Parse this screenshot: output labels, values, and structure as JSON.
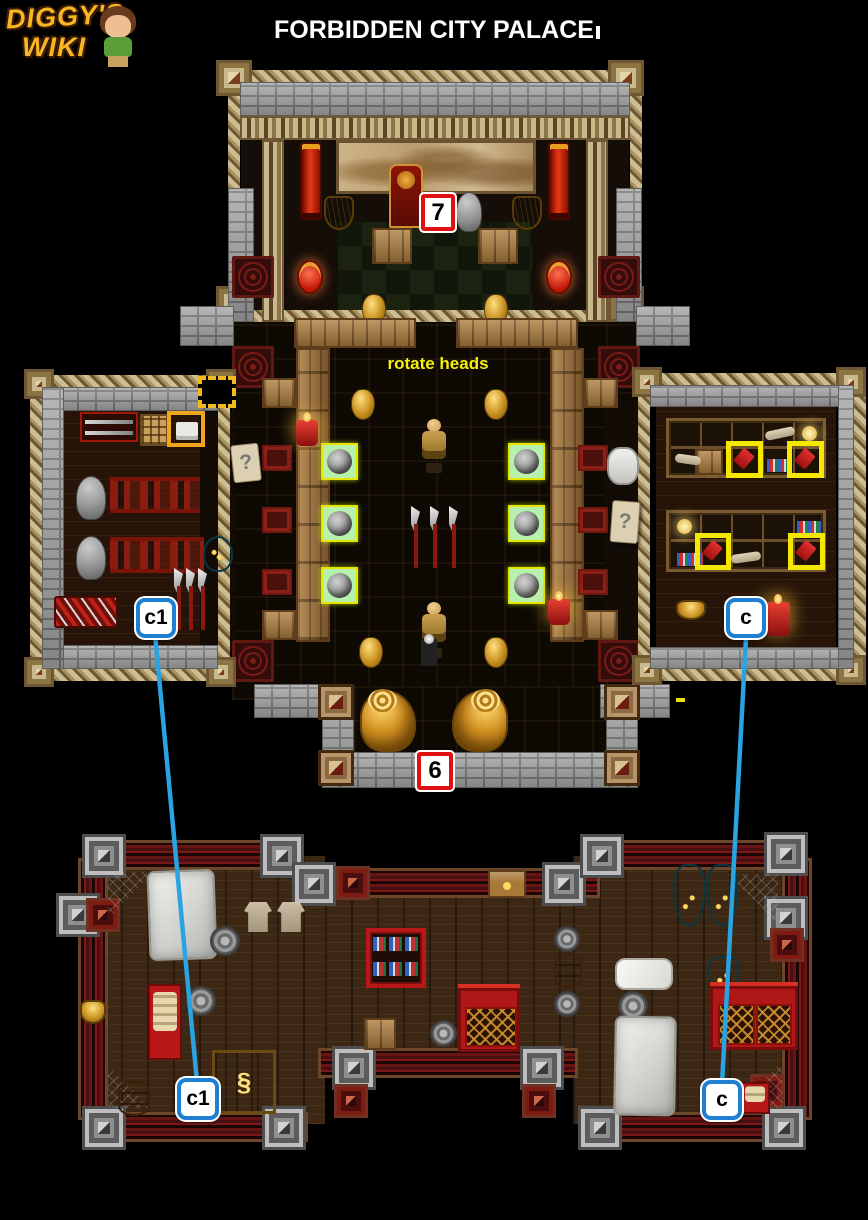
{
  "header": {
    "logo_line1": "DIGGY'S",
    "logo_line2": "WIKI",
    "title": "FORBIDDEN CITY PALACE"
  },
  "annotations": {
    "rotate_heads": "rotate heads",
    "question_left": "?",
    "question_right": "?"
  },
  "markers": {
    "m7": {
      "label": "7",
      "style": "red-square"
    },
    "m6": {
      "label": "6",
      "style": "red-square"
    },
    "c1_upper": {
      "label": "c1",
      "style": "blue-rounded"
    },
    "c_upper": {
      "label": "c",
      "style": "blue-rounded"
    },
    "c1_lower": {
      "label": "c1",
      "style": "blue-rounded"
    },
    "c_lower": {
      "label": "c",
      "style": "blue-rounded"
    }
  },
  "connectors": [
    {
      "from": "c1_upper",
      "to": "c1_lower",
      "color": "#2aa3e2"
    },
    {
      "from": "c_upper",
      "to": "c_lower",
      "color": "#2aa3e2"
    }
  ],
  "colors": {
    "background": "#000000",
    "marker_red_border": "#e01111",
    "marker_blue_border": "#1f7fd0",
    "highlight_yellow": "#f5e800",
    "highlight_orange": "#f0a51e",
    "highlight_green": "#b6f2ac",
    "annotation_text_yellow": "#f5f00a",
    "connector_blue": "#2aa3e2",
    "logo_gold": "#f8b624"
  }
}
